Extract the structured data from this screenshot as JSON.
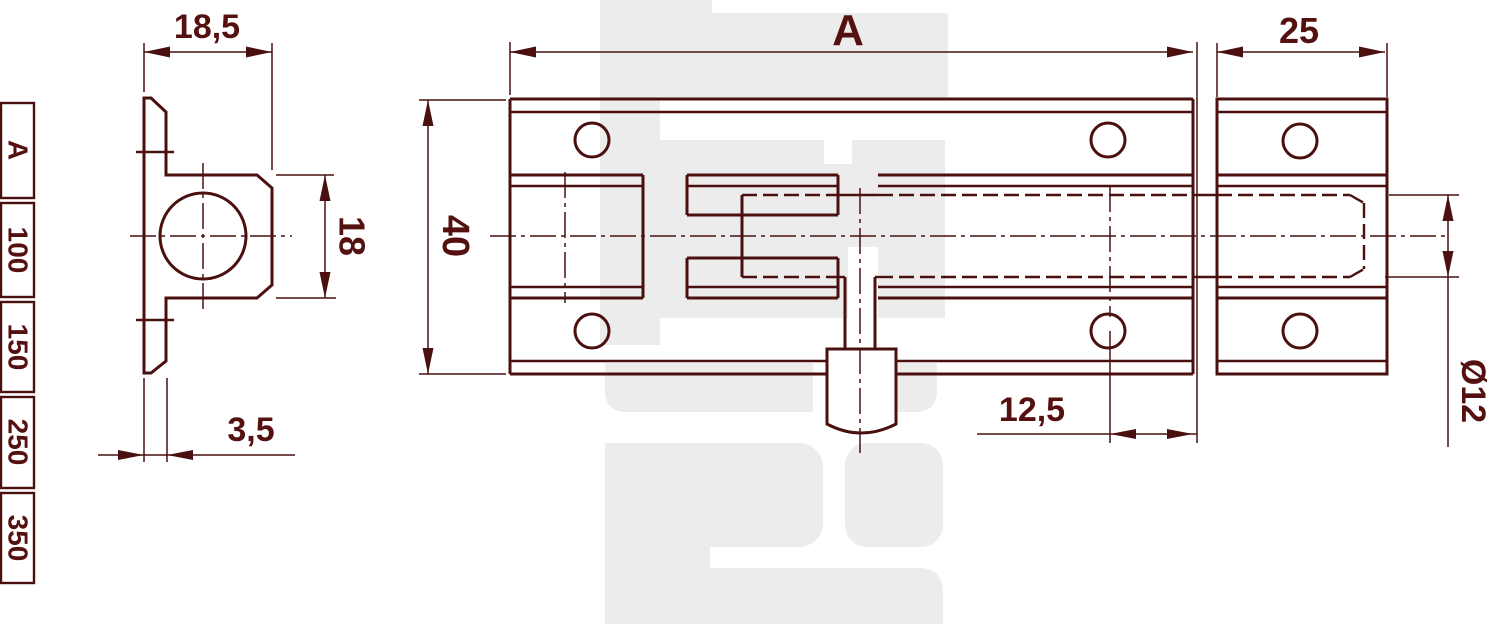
{
  "drawing": {
    "title": "barrel-bolt-technical-drawing",
    "dimensions": {
      "total_length": "A",
      "keeper_length": "25",
      "plate_height": "40",
      "side_flange_width": "18,5",
      "side_boss_height": "18",
      "plate_thickness": "3,5",
      "hole_edge_offset": "12,5",
      "bolt_diameter": "Ø12"
    },
    "size_table": {
      "header": "A",
      "values": [
        "100",
        "150",
        "250",
        "350"
      ]
    },
    "colors": {
      "line": "#4a1010",
      "text": "#551010",
      "watermark": "#ececec",
      "background": "#ffffff"
    }
  }
}
